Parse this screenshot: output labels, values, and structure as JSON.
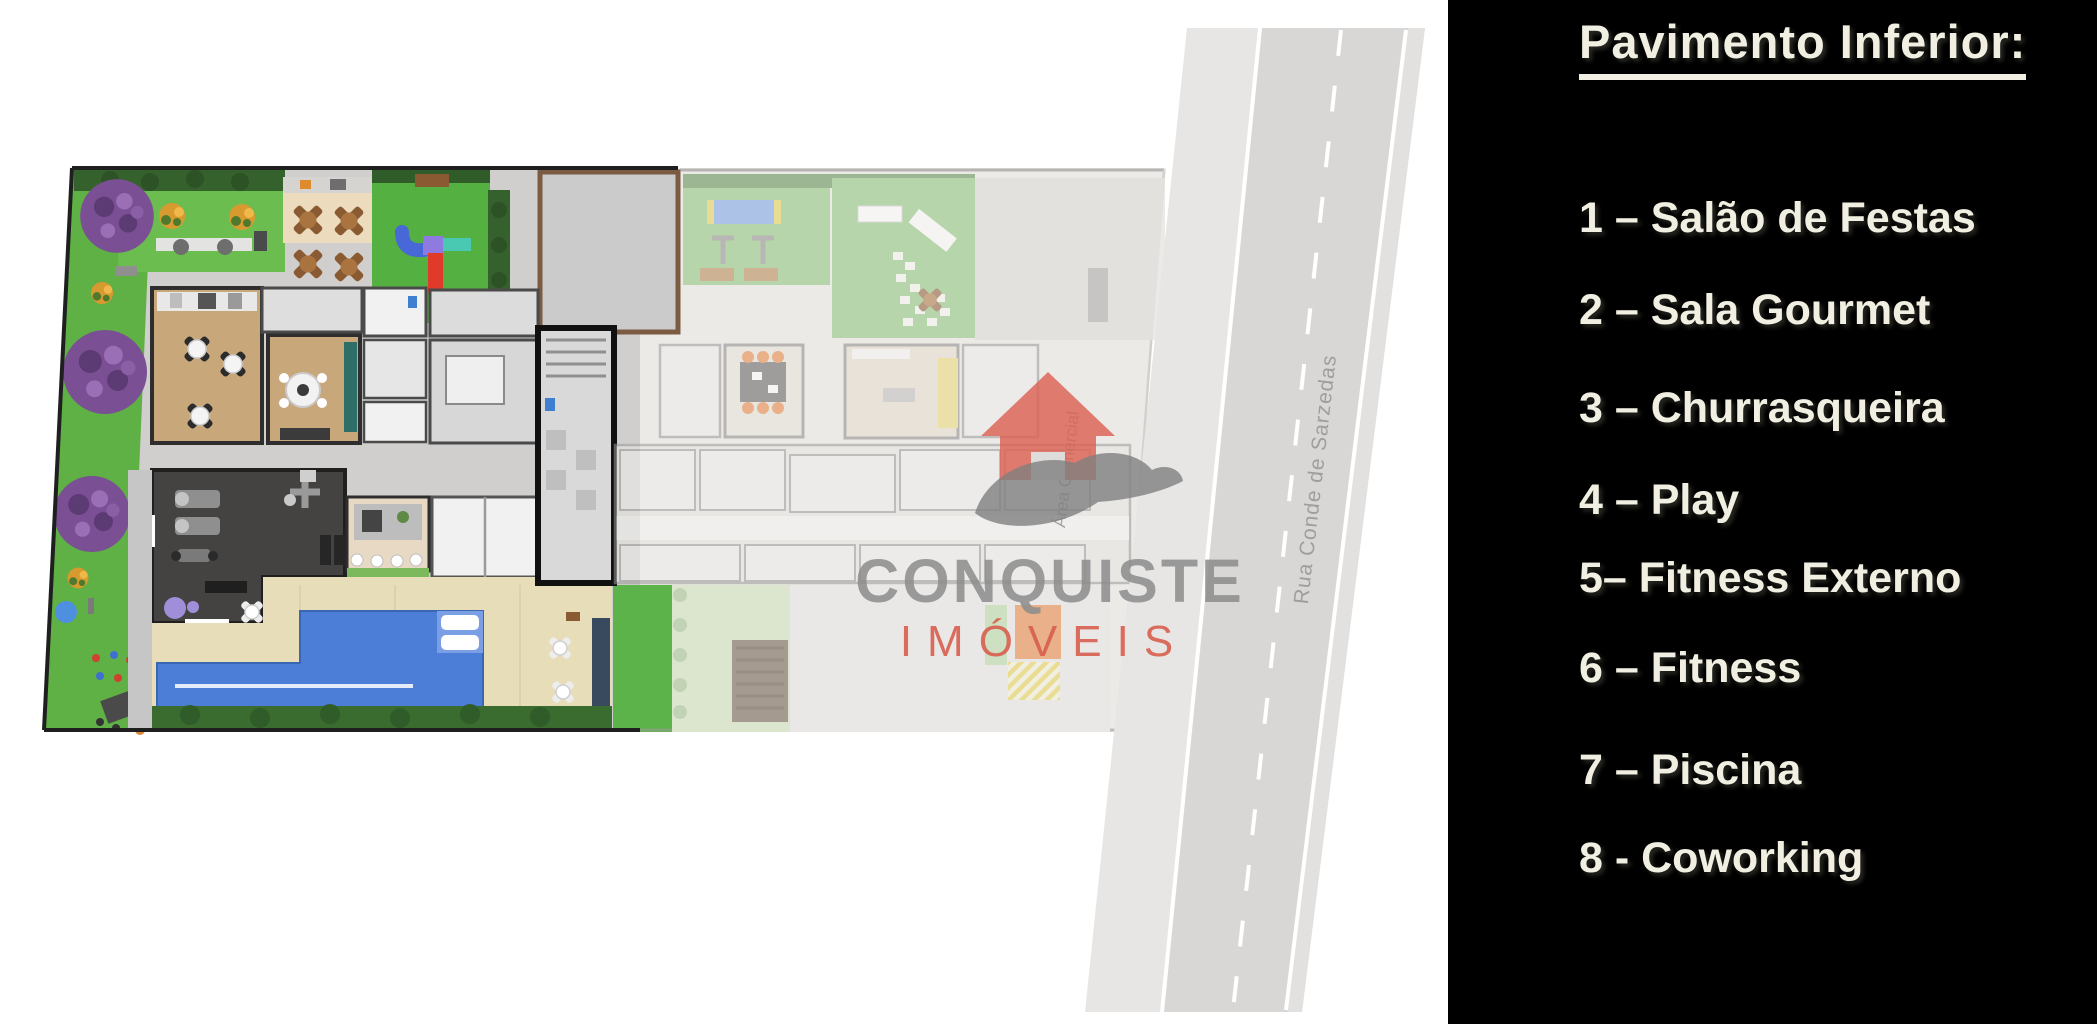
{
  "legend_panel": {
    "background": "#000000",
    "text_color": "#f1eee2",
    "title": "Pavimento Inferior:",
    "items": [
      "1 – Salão de Festas",
      "2 – Sala Gourmet",
      "3 – Churrasqueira",
      "4 – Play",
      "5– Fitness Externo",
      "6 – Fitness",
      "7 – Piscina",
      "8 - Coworking"
    ]
  },
  "watermark": {
    "brand": "CONQUISTE",
    "subtitle": "IMÓVEIS",
    "brand_color": "#8c8c8c",
    "subtitle_color": "#d85f4e",
    "house_color": "#dd6254",
    "hand_color": "#7f7f7f"
  },
  "plan": {
    "street_label": "Rua Conde de Sarzedas",
    "commercial_area_label": "Área Comercial",
    "colors": {
      "lawn_green": "#6cbd4f",
      "playground_green": "#53b041",
      "hedge_green": "#35622c",
      "pool_blue": "#4c7ed8",
      "deck_beige": "#e7ddb9",
      "wood_floor": "#c8a77b",
      "fitness_dark": "#454341",
      "paving_gray": "#d0cfcd",
      "road_gray": "#d9d8d6",
      "tree_purple": "#7a4f93"
    }
  }
}
